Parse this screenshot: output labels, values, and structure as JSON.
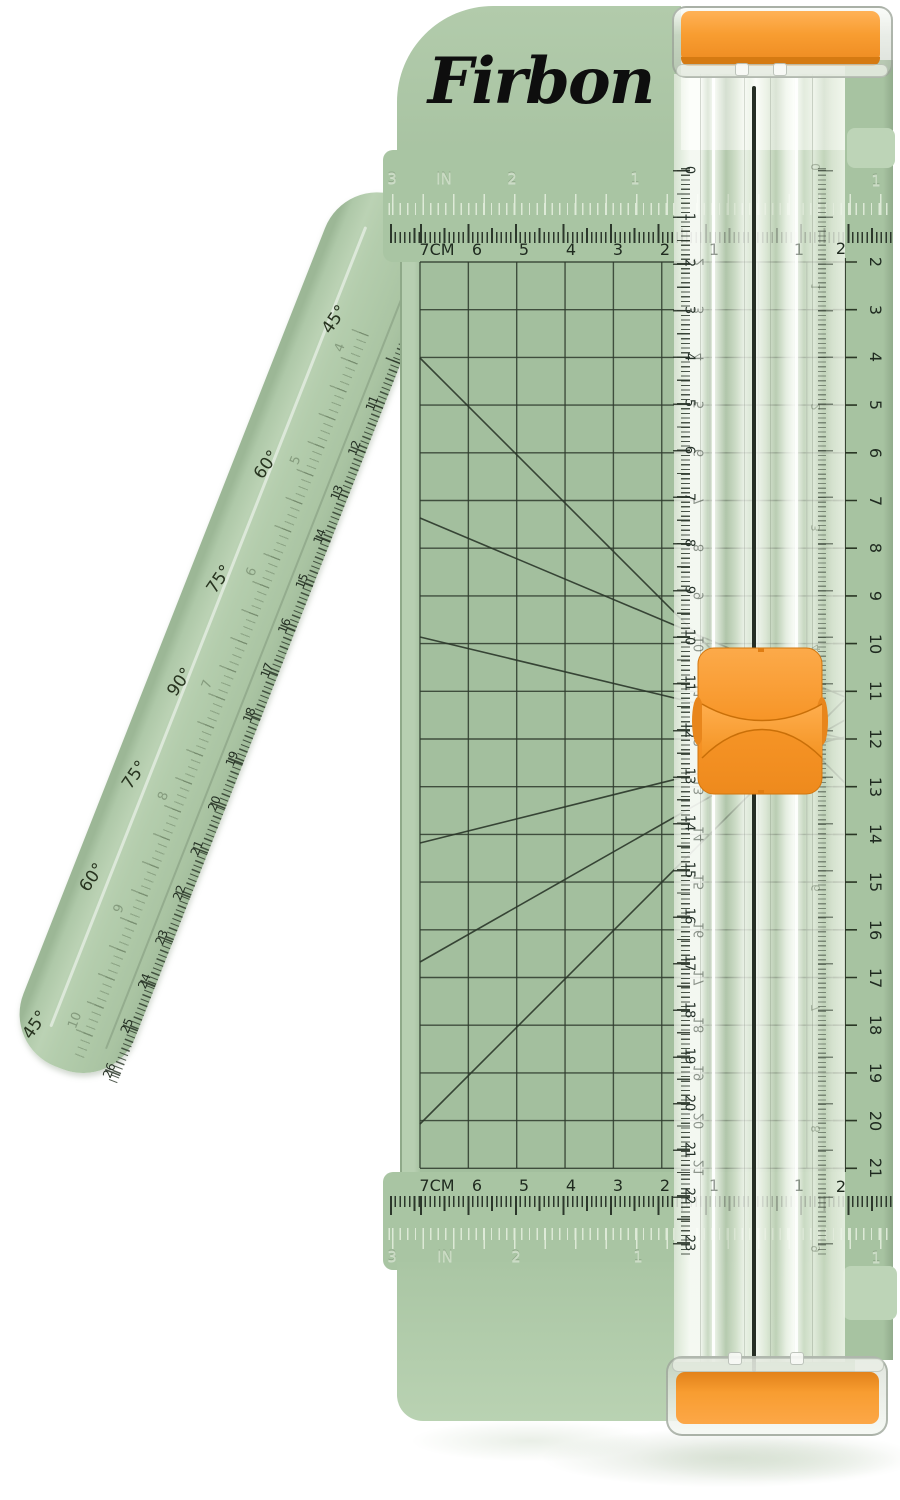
{
  "brand": "Firbon",
  "colors": {
    "body_green": "#a9c5a3",
    "mat_green": "#a3bf9e",
    "arm_green": "#b3ccac",
    "accent_orange": "#f89d31",
    "marking_dark": "#2c372b",
    "engraved_light": "#d8e6d2"
  },
  "scales": {
    "inch_header": [
      "3",
      "IN",
      "2",
      "1"
    ],
    "inch_header_right": "1",
    "cm_header": [
      "7CM",
      "6",
      "5",
      "4",
      "3",
      "2"
    ],
    "cm_header_faint": [
      "1",
      "1"
    ],
    "cm_header_right": "2",
    "rail": [
      "0",
      "1",
      "2",
      "3",
      "4",
      "5",
      "6",
      "7",
      "8",
      "9",
      "10",
      "11",
      "12",
      "13",
      "14",
      "15",
      "16",
      "17",
      "18",
      "19",
      "20",
      "21",
      "22",
      "23"
    ],
    "rail_inch": [
      "0",
      "1",
      "2",
      "3",
      "4",
      "5",
      "6",
      "7",
      "8",
      "9"
    ],
    "right_cm": [
      "2",
      "3",
      "4",
      "5",
      "6",
      "7",
      "8",
      "9",
      "10",
      "11",
      "12",
      "13",
      "14",
      "15",
      "16",
      "17",
      "18",
      "19",
      "20",
      "21"
    ],
    "under_rail_cm": [
      "2",
      "3",
      "4",
      "5",
      "6",
      "7",
      "8",
      "9",
      "10",
      "11",
      "12",
      "13",
      "14",
      "15",
      "16",
      "17",
      "18",
      "19",
      "20",
      "21"
    ],
    "arm_angles": [
      "45°",
      "60°",
      "75°",
      "90°",
      "75°",
      "60°",
      "45°"
    ],
    "arm_inch": [
      "4",
      "5",
      "6",
      "7",
      "8",
      "9",
      "10"
    ],
    "arm_cm": [
      "11",
      "12",
      "13",
      "14",
      "15",
      "16",
      "17",
      "18",
      "19",
      "20",
      "21",
      "22",
      "23",
      "24",
      "25",
      "26"
    ]
  }
}
